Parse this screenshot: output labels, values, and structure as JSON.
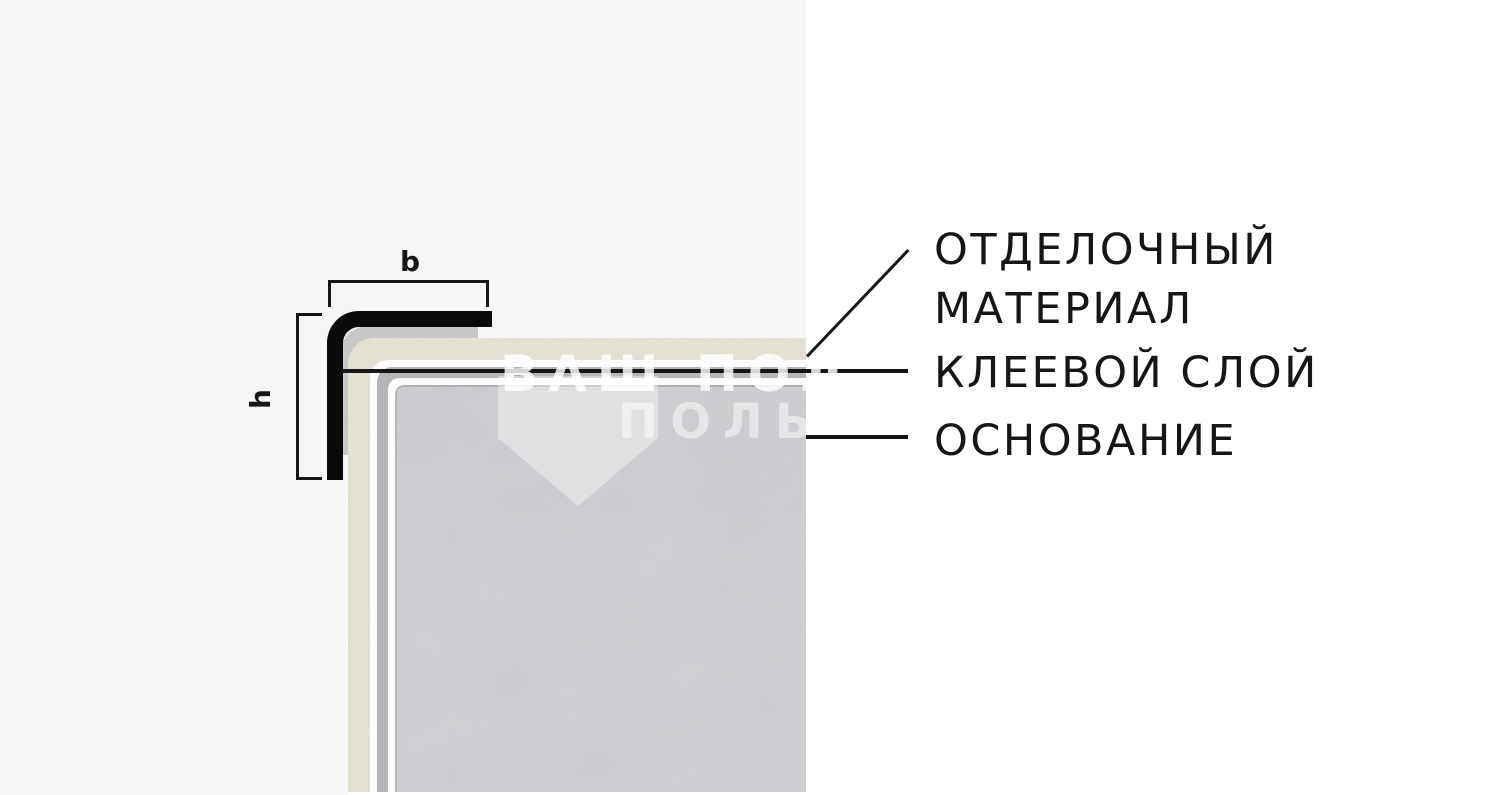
{
  "page": {
    "background_left": "#f6f6f6",
    "background_right": "#ffffff"
  },
  "diagram": {
    "title": "Corner profile installation scheme",
    "dimensions": {
      "width_label": "b",
      "height_label": "h"
    },
    "callouts": {
      "finishing_material_line1": "ОТДЕЛОЧНЫЙ",
      "finishing_material_line2": "МАТЕРИАЛ",
      "adhesive_layer": "КЛЕЕВОЙ СЛОЙ",
      "base": "ОСНОВАНИЕ"
    },
    "colors": {
      "profile": "#0a0a0a",
      "profile_shadow": "#c8c8c8",
      "finishing_material": "#eae7db",
      "gap_white": "#fdfdfd",
      "adhesive_layer": "#b5b5b7",
      "substrate": "#d2d3d5",
      "ink": "#161616"
    }
  },
  "watermark": {
    "line1": "ВАШ ПОЛ",
    "line2": "ПОЛЬ"
  }
}
